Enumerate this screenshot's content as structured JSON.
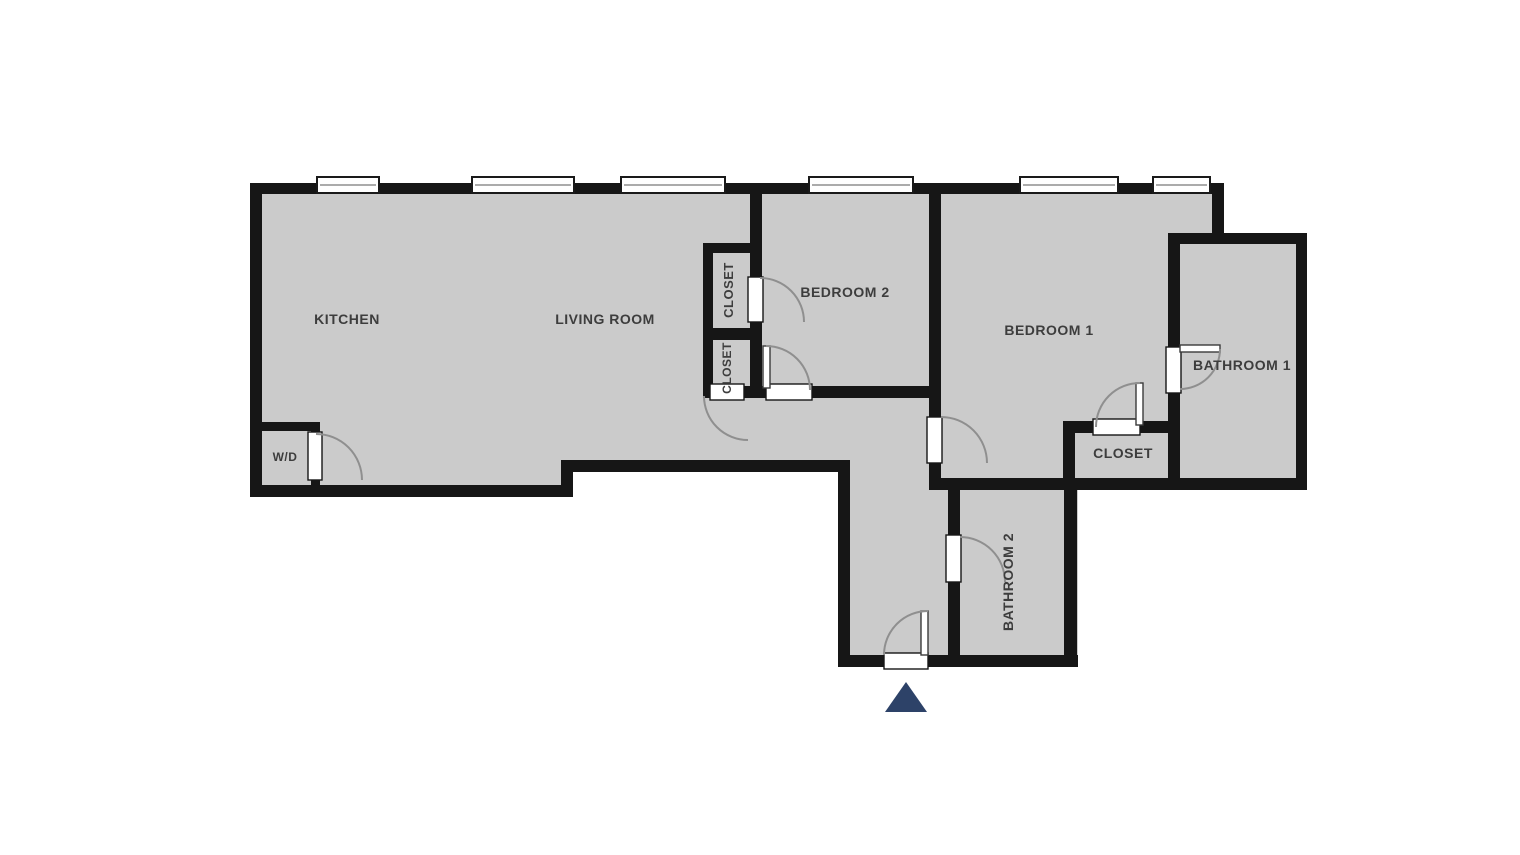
{
  "colors": {
    "background": "#ffffff",
    "floor": "#cbcbcb",
    "wall": "#161616",
    "door_arc": "#8f8f8f",
    "label": "#3d3d3d",
    "entry_arrow": "#2d4268",
    "window_fill": "#ffffff",
    "window_border": "#1a1a1a",
    "window_mid": "#8f8f8f",
    "leaf_border": "#3a3a3a"
  },
  "floorplan": {
    "footprint": "250,183 1224,183 1224,233 1307,233 1307,490 1078,490 1078,667 838,667 838,472 573,472 573,497 250,497",
    "walls": [
      {
        "name": "outer-top",
        "x": 250,
        "y": 183,
        "w": 974,
        "h": 11
      },
      {
        "name": "outer-right-upper",
        "x": 1212,
        "y": 183,
        "w": 12,
        "h": 56
      },
      {
        "name": "bathroom1-top",
        "x": 1168,
        "y": 233,
        "w": 139,
        "h": 11
      },
      {
        "name": "bathroom1-right",
        "x": 1296,
        "y": 233,
        "w": 11,
        "h": 257
      },
      {
        "name": "bottom-long",
        "x": 929,
        "y": 478,
        "w": 378,
        "h": 12
      },
      {
        "name": "bathroom2-right",
        "x": 1064,
        "y": 478,
        "w": 13,
        "h": 189
      },
      {
        "name": "hall-bottom",
        "x": 838,
        "y": 655,
        "w": 240,
        "h": 12
      },
      {
        "name": "hall-left",
        "x": 838,
        "y": 460,
        "w": 12,
        "h": 207
      },
      {
        "name": "living-bottom-right",
        "x": 561,
        "y": 460,
        "w": 289,
        "h": 12
      },
      {
        "name": "living-bottom-step",
        "x": 561,
        "y": 460,
        "w": 12,
        "h": 37
      },
      {
        "name": "living-bottom-left",
        "x": 250,
        "y": 485,
        "w": 323,
        "h": 12
      },
      {
        "name": "outer-left",
        "x": 250,
        "y": 183,
        "w": 12,
        "h": 314
      },
      {
        "name": "wd-top",
        "x": 250,
        "y": 422,
        "w": 70,
        "h": 9
      },
      {
        "name": "wd-right",
        "x": 311,
        "y": 422,
        "w": 9,
        "h": 75
      },
      {
        "name": "closets-left",
        "x": 703,
        "y": 243,
        "w": 10,
        "h": 155
      },
      {
        "name": "closets-top",
        "x": 703,
        "y": 243,
        "w": 59,
        "h": 10
      },
      {
        "name": "closets-divider",
        "x": 703,
        "y": 328,
        "w": 59,
        "h": 12
      },
      {
        "name": "living-bedroom2",
        "x": 750,
        "y": 183,
        "w": 12,
        "h": 215
      },
      {
        "name": "bedroom2-bottom",
        "x": 703,
        "y": 386,
        "w": 238,
        "h": 12
      },
      {
        "name": "bedroom2-bedroom1",
        "x": 929,
        "y": 183,
        "w": 12,
        "h": 307
      },
      {
        "name": "bathroom2-left",
        "x": 948,
        "y": 478,
        "w": 12,
        "h": 189
      },
      {
        "name": "bedroom1-closet-top",
        "x": 1063,
        "y": 421,
        "w": 117,
        "h": 12
      },
      {
        "name": "bedroom1-closet-left",
        "x": 1063,
        "y": 421,
        "w": 12,
        "h": 69
      },
      {
        "name": "bathroom1-left",
        "x": 1168,
        "y": 233,
        "w": 12,
        "h": 257
      }
    ],
    "windows": [
      {
        "name": "window-1",
        "x": 317,
        "w": 62
      },
      {
        "name": "window-2",
        "x": 472,
        "w": 102
      },
      {
        "name": "window-3",
        "x": 621,
        "w": 104
      },
      {
        "name": "window-4",
        "x": 809,
        "w": 104
      },
      {
        "name": "window-5",
        "x": 1020,
        "w": 98
      },
      {
        "name": "window-6",
        "x": 1153,
        "w": 57
      }
    ],
    "window_y": 177,
    "window_h": 16,
    "door_gaps": [
      {
        "name": "wd-door-gap",
        "x": 308,
        "y": 432,
        "w": 14,
        "h": 48
      },
      {
        "name": "closet-top-door-gap",
        "x": 748,
        "y": 277,
        "w": 15,
        "h": 45
      },
      {
        "name": "closet-bottom-door-gap",
        "x": 710,
        "y": 384,
        "w": 34,
        "h": 16
      },
      {
        "name": "bedroom2-door-gap",
        "x": 766,
        "y": 384,
        "w": 46,
        "h": 16
      },
      {
        "name": "bedroom1-door-gap",
        "x": 927,
        "y": 417,
        "w": 15,
        "h": 46
      },
      {
        "name": "bedroom1-closet-door-gap",
        "x": 1093,
        "y": 419,
        "w": 47,
        "h": 16
      },
      {
        "name": "bathroom1-door-gap",
        "x": 1166,
        "y": 347,
        "w": 15,
        "h": 46
      },
      {
        "name": "bathroom2-door-gap",
        "x": 946,
        "y": 535,
        "w": 15,
        "h": 47
      },
      {
        "name": "entry-door-gap",
        "x": 884,
        "y": 653,
        "w": 44,
        "h": 16
      }
    ],
    "door_leaves": [
      {
        "name": "bedroom2-door-leaf",
        "x": 763,
        "y": 346,
        "w": 7,
        "h": 42
      },
      {
        "name": "bedroom1-closet-door-leaf",
        "x": 1136,
        "y": 383,
        "w": 7,
        "h": 42
      },
      {
        "name": "entry-door-leaf",
        "x": 921,
        "y": 611,
        "w": 7,
        "h": 44
      },
      {
        "name": "bathroom1-door-leaf",
        "x": 1180,
        "y": 345,
        "w": 40,
        "h": 7
      }
    ],
    "door_arcs": [
      {
        "name": "wd-door-arc",
        "d": "M316,434 A46,46 0 0 1 362,480"
      },
      {
        "name": "closet-top-door-arc",
        "d": "M760,278 A44,44 0 0 1 804,322"
      },
      {
        "name": "closet-bottom-door-arc",
        "d": "M704,396 A44,44 0 0 0 748,440"
      },
      {
        "name": "bedroom2-door-arc",
        "d": "M766,346 A44,44 0 0 1 810,390"
      },
      {
        "name": "bedroom1-door-arc",
        "d": "M941,417 A46,46 0 0 1 987,463"
      },
      {
        "name": "bedroom1-closet-door-arc",
        "d": "M1140,383 A44,44 0 0 0 1096,427"
      },
      {
        "name": "bathroom1-door-arc",
        "d": "M1220,349 A40,40 0 0 1 1180,389"
      },
      {
        "name": "bathroom2-door-arc",
        "d": "M960,537 A45,45 0 0 1 1005,582"
      },
      {
        "name": "entry-door-arc",
        "d": "M928,611 A44,44 0 0 0 884,655"
      }
    ],
    "rooms": [
      {
        "name": "room-label-kitchen",
        "label": "KITCHEN",
        "x": 347,
        "y": 324,
        "rotate": 0,
        "size": 14
      },
      {
        "name": "room-label-living-room",
        "label": "LIVING ROOM",
        "x": 605,
        "y": 324,
        "rotate": 0,
        "size": 14
      },
      {
        "name": "room-label-bedroom-2",
        "label": "BEDROOM 2",
        "x": 845,
        "y": 297,
        "rotate": 0,
        "size": 14
      },
      {
        "name": "room-label-bedroom-1",
        "label": "BEDROOM 1",
        "x": 1049,
        "y": 335,
        "rotate": 0,
        "size": 14
      },
      {
        "name": "room-label-bathroom-1",
        "label": "BATHROOM 1",
        "x": 1242,
        "y": 370,
        "rotate": 0,
        "size": 14
      },
      {
        "name": "room-label-closet-bedroom1",
        "label": "CLOSET",
        "x": 1123,
        "y": 458,
        "rotate": 0,
        "size": 14
      },
      {
        "name": "room-label-wd",
        "label": "W/D",
        "x": 285,
        "y": 461,
        "rotate": 0,
        "size": 12
      },
      {
        "name": "room-label-closet-top",
        "label": "CLOSET",
        "x": 733,
        "y": 290,
        "rotate": -90,
        "size": 13
      },
      {
        "name": "room-label-closet-bottom",
        "label": "CLOSET",
        "x": 731,
        "y": 368,
        "rotate": -90,
        "size": 12
      },
      {
        "name": "room-label-bathroom-2",
        "label": "BATHROOM 2",
        "x": 1013,
        "y": 582,
        "rotate": -90,
        "size": 14
      }
    ],
    "entry_arrow": {
      "name": "entry-arrow",
      "points": "906,682 885,712 927,712"
    }
  }
}
